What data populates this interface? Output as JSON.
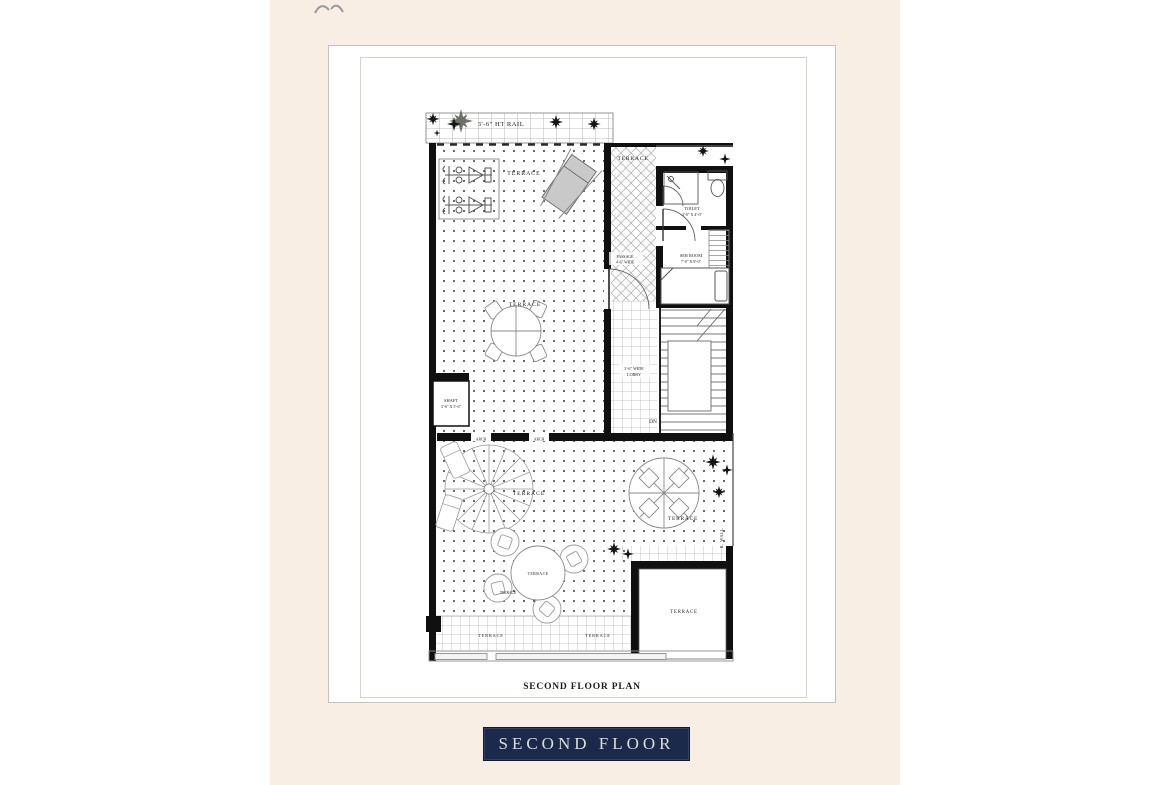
{
  "page": {
    "panel_color": "#f8eee3",
    "card_color": "#ffffff",
    "line_color": "#111111"
  },
  "plan": {
    "caption": "SECOND FLOOR PLAN",
    "labels": {
      "rail": "3'-6\" HT RAIL",
      "terrace_gym": "TERRACE",
      "terrace_upper_right": "TERRACE",
      "terrace_upper_center": "TERRACE",
      "toilet_name": "TOILET",
      "toilet_size": "4'-0\" X 4'-0\"",
      "ser_room_name": "SER ROOM",
      "ser_room_size": "7'-0\" X 8'-0\"",
      "passage_line1": "PASSAGE",
      "passage_line2": "4'-6\" WIDE",
      "lobby_line1": "3'-6\" WIDE",
      "lobby_line2": "LOBBY",
      "shaft_name": "SHAFT",
      "shaft_size": "3'-6\" X 5'-6\"",
      "dn": "DN",
      "arch_left": "ARCH",
      "arch_right": "ARCH",
      "terrace_lower_left": "TERRACE",
      "terrace_table": "TERRACE",
      "terrace_table_small": "TERRACE",
      "terrace_lower_right": "TERRACE",
      "r_wall": "R. WALL",
      "terrace_room": "TERRACE",
      "terrace_bottom_left": "TERRACE",
      "terrace_bottom_right": "TERRACE"
    }
  },
  "footer": {
    "floor_label": "SECOND FLOOR",
    "label_bg": "#1b2a4a",
    "label_text_color": "#dedcd6"
  }
}
